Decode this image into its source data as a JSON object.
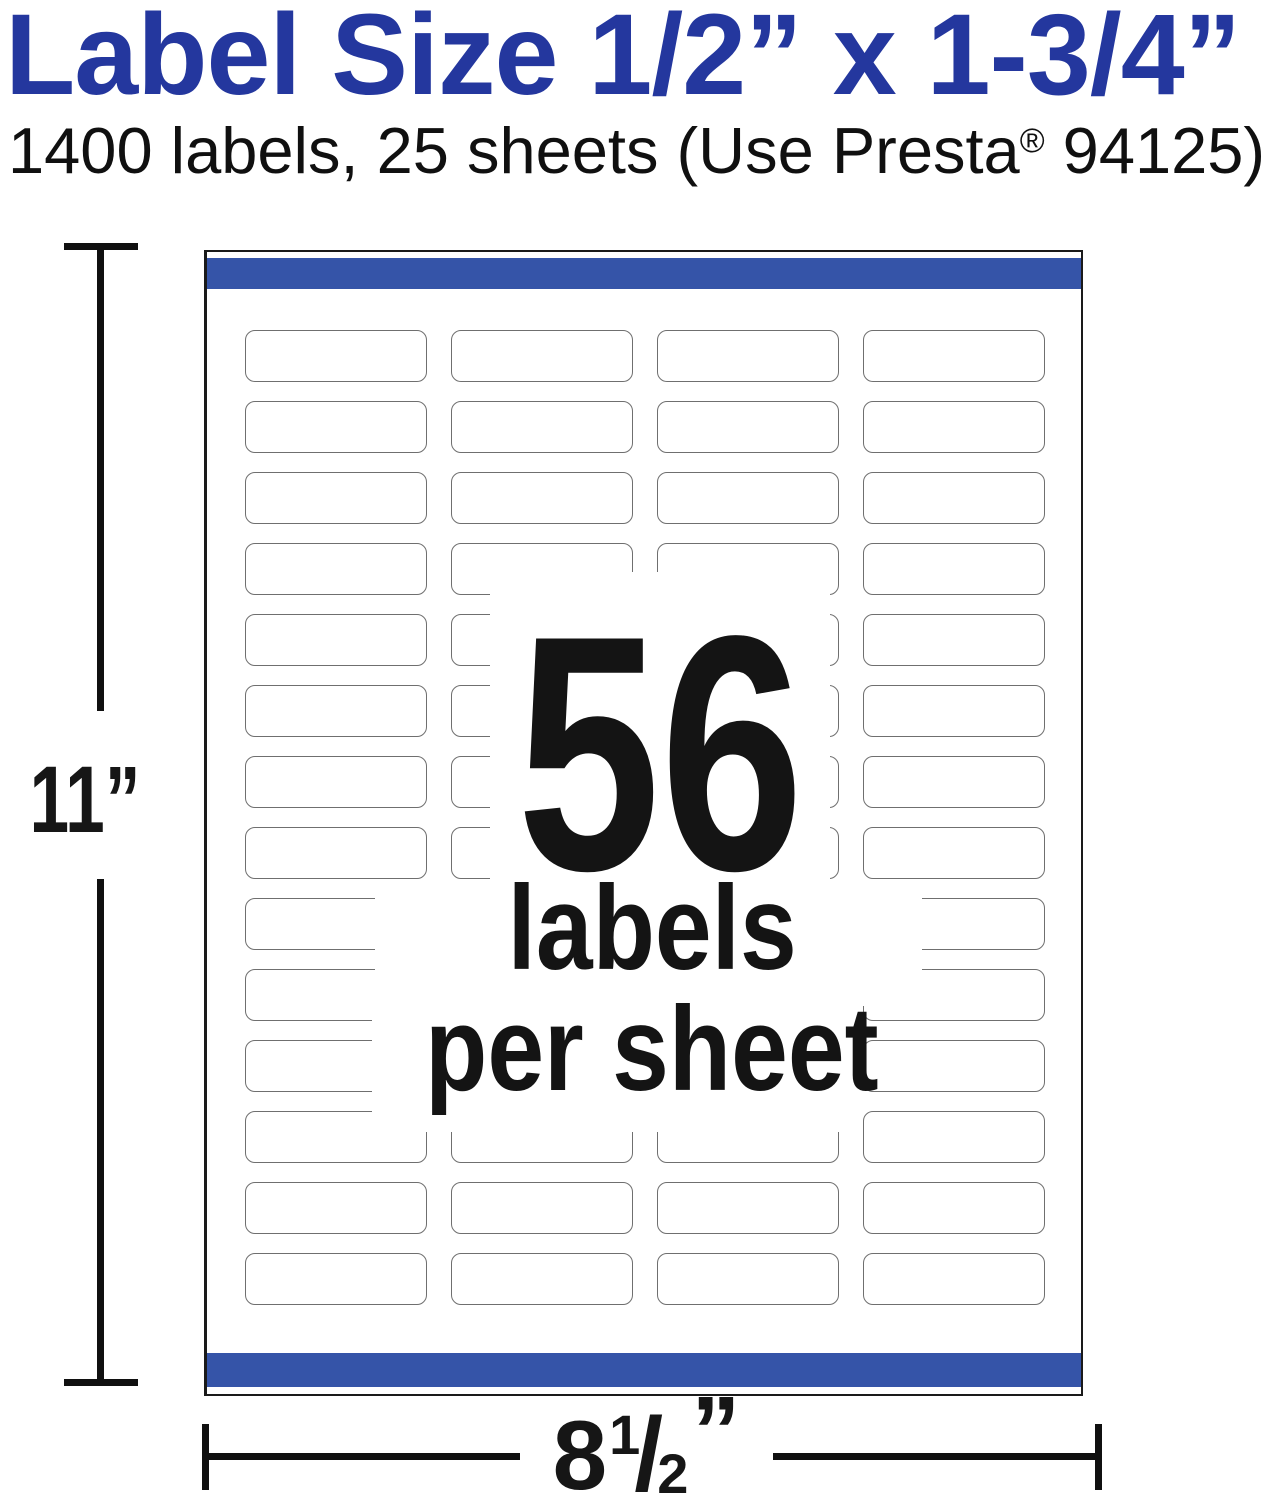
{
  "header": {
    "title": "Label Size 1/2” x 1-3/4”",
    "subtitle_pre": "1400 labels, 25 sheets (Use Presta",
    "subtitle_reg_mark": "®",
    "subtitle_post": " 94125)"
  },
  "sheet": {
    "rows": 14,
    "columns": 4
  },
  "overlay": {
    "count": "56",
    "line2": "labels",
    "line3": "per sheet"
  },
  "dimensions": {
    "height": "11”",
    "width_whole": "8",
    "width_num": "1",
    "width_slash": "/",
    "width_den": "2",
    "width_unit": "”"
  },
  "colors": {
    "title_blue": "#24379E",
    "bar_blue": "#3554A8"
  }
}
